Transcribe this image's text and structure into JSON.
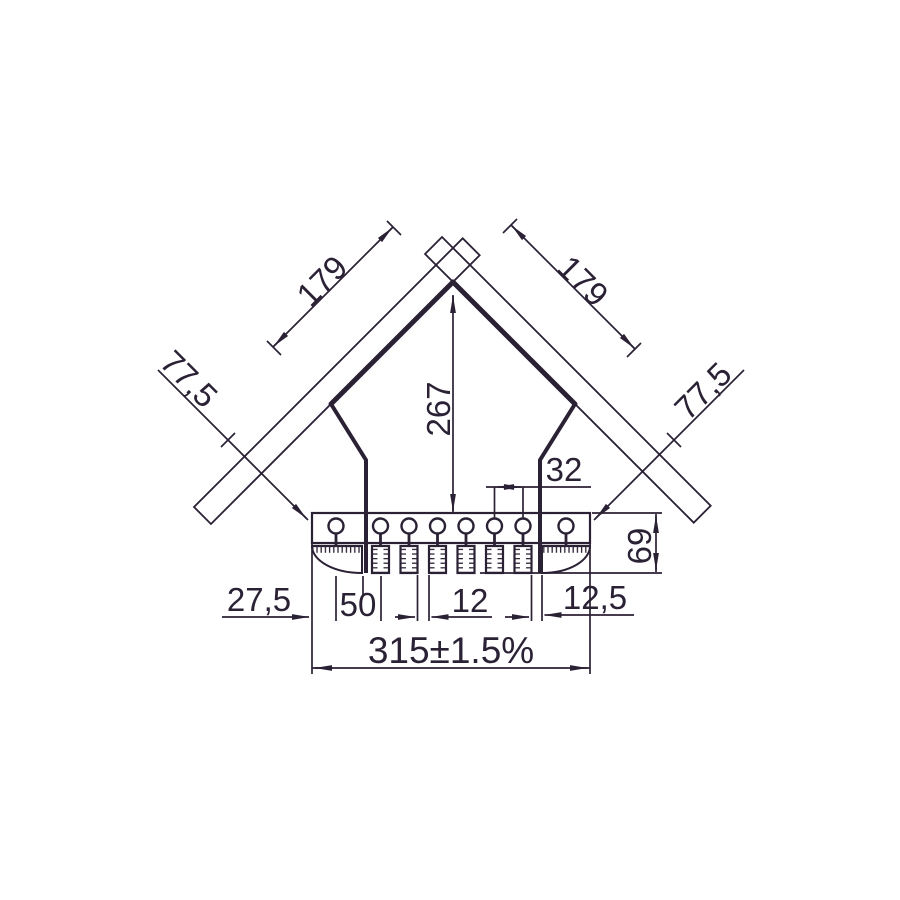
{
  "drawing": {
    "type": "technical-dimension-drawing",
    "subject": "roof corner profile with brush inserts",
    "style": {
      "line_color": "#2b2135",
      "background_color": "#ffffff"
    },
    "dimensions": {
      "left_batten_length": "179",
      "right_batten_length": "179",
      "left_flank_overhang": "77,5",
      "right_flank_overhang": "77,5",
      "apex_height": "267",
      "hole_pitch": "32",
      "base_height": "69",
      "edge_to_first_hole": "27,5",
      "first_hole_spacing": "50",
      "brush_gap": "12",
      "end_brush_gap": "12,5",
      "overall_width": "315±1.5%"
    },
    "counts": {
      "mounting_holes": 8,
      "brush_segments": 6,
      "end_brushes": 2,
      "battens": 2
    }
  }
}
